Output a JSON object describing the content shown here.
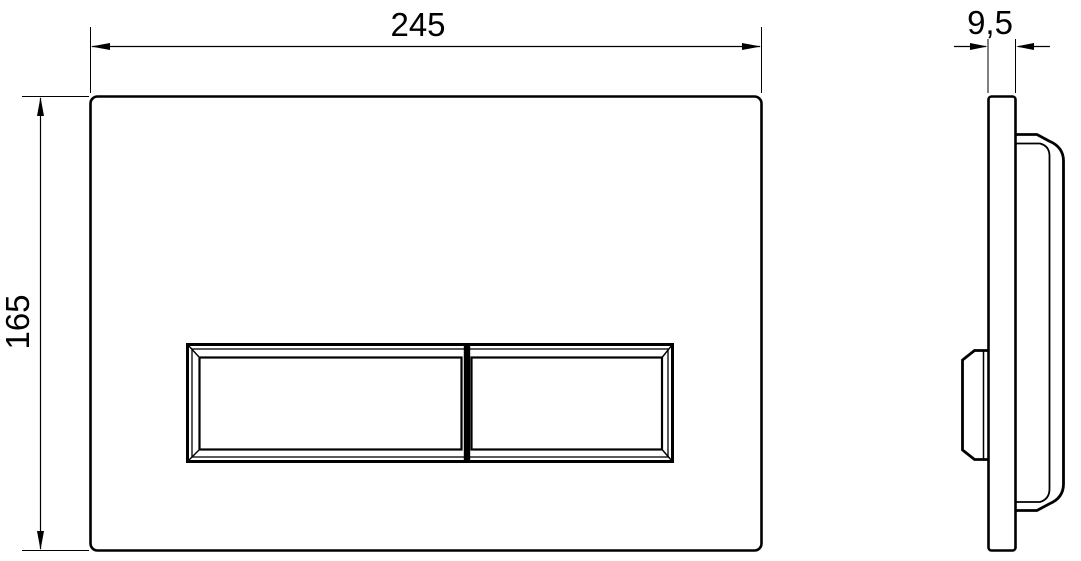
{
  "drawing": {
    "dimensions": {
      "front_width": {
        "label": "245"
      },
      "front_height": {
        "label": "165"
      },
      "side_thickness": {
        "label": "9,5"
      }
    }
  },
  "colors": {
    "line": "#000000",
    "background": "#ffffff"
  }
}
